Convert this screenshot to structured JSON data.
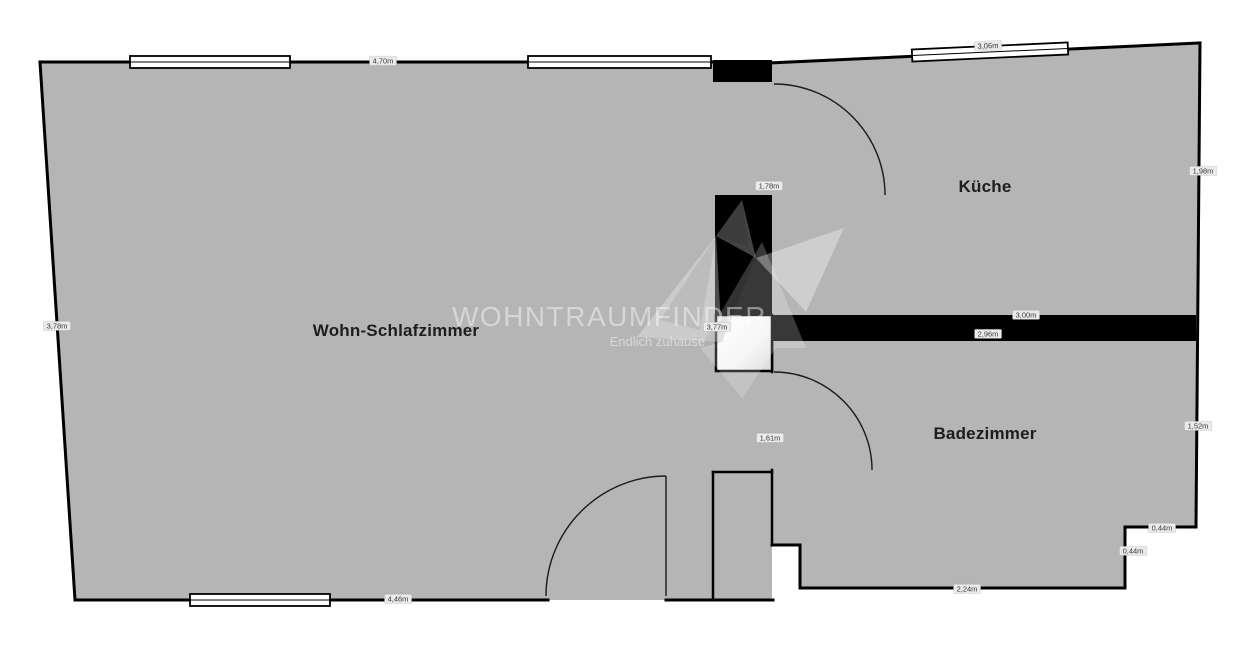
{
  "watermark": {
    "brand": "WOHNTRAUMFINDER",
    "tagline": "Endlich zuhause"
  },
  "rooms": [
    {
      "name": "Wohn-Schlafzimmer"
    },
    {
      "name": "Küche"
    },
    {
      "name": "Badezimmer"
    }
  ],
  "dimensions": [
    {
      "text": "4,70m",
      "location": "top-left-wall"
    },
    {
      "text": "3,06m",
      "location": "kitchen-top-wall"
    },
    {
      "text": "1,98m",
      "location": "kitchen-right-wall"
    },
    {
      "text": "1,78m",
      "location": "kitchen-left-wall"
    },
    {
      "text": "3,77m",
      "location": "living-room-right-height"
    },
    {
      "text": "3,00m",
      "location": "divider-wall-top"
    },
    {
      "text": "2,96m",
      "location": "divider-wall-bottom"
    },
    {
      "text": "3,78m",
      "location": "left-wall"
    },
    {
      "text": "1,61m",
      "location": "corridor-wall"
    },
    {
      "text": "1,52m",
      "location": "bathroom-right-wall"
    },
    {
      "text": "0,44m",
      "location": "bathroom-step-horizontal"
    },
    {
      "text": "0,44m",
      "location": "bathroom-step-vertical"
    },
    {
      "text": "2,24m",
      "location": "bathroom-bottom-wall"
    },
    {
      "text": "4,46m",
      "location": "bottom-left-wall"
    }
  ],
  "colors": {
    "floor": "#b5b5b5",
    "wall": "#000000",
    "window": "#ffffff",
    "label_bg": "#eaeaea",
    "background": "#ffffff"
  }
}
